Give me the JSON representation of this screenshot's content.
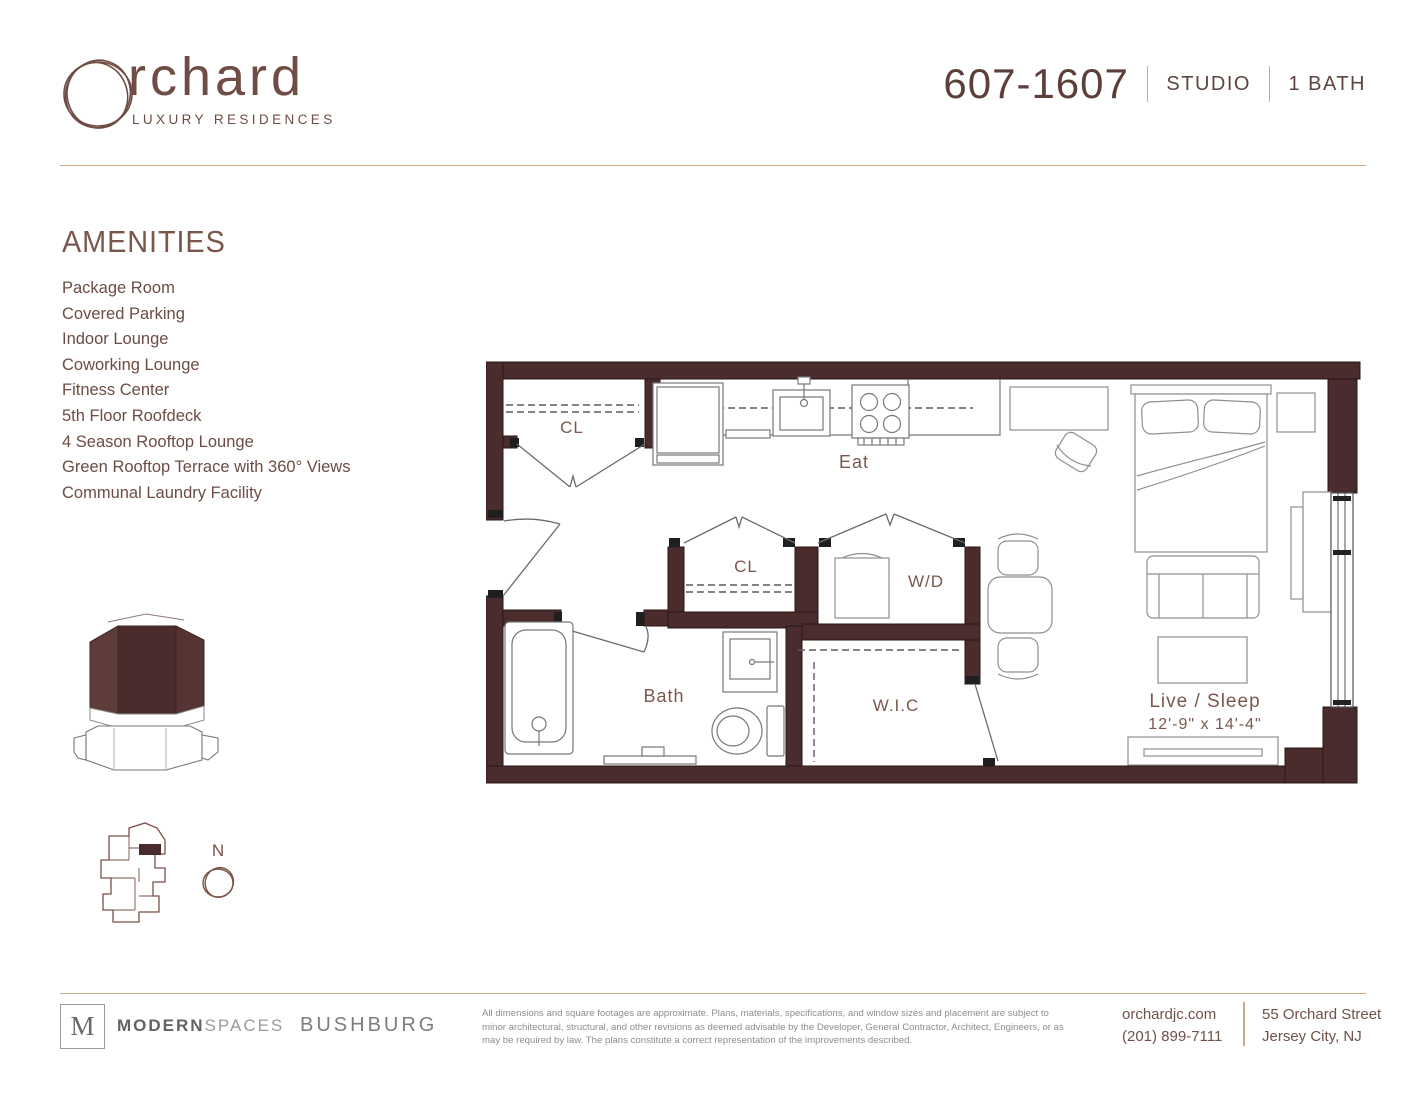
{
  "header": {
    "brand_text": "rchard",
    "brand_tagline": "LUXURY RESIDENCES",
    "unit_number": "607-1607",
    "unit_type": "STUDIO",
    "unit_bath": "1 BATH"
  },
  "amenities": {
    "heading": "AMENITIES",
    "items": [
      "Package Room",
      "Covered Parking",
      "Indoor Lounge",
      "Coworking Lounge",
      "Fitness Center",
      "5th Floor Roofdeck",
      "4 Season Rooftop Lounge",
      "Green Rooftop Terrace with 360° Views",
      "Communal Laundry Facility"
    ]
  },
  "floorplan": {
    "closet_top": "CL",
    "eat": "Eat",
    "closet_mid": "CL",
    "washer_dryer": "W/D",
    "bath": "Bath",
    "walk_in_closet": "W.I.C",
    "live_sleep": "Live / Sleep",
    "live_sleep_dims": "12'-9\" x 14'-4\"",
    "compass": "N"
  },
  "footer": {
    "broker_logo_letter": "M",
    "broker_name_bold": "MODERN",
    "broker_name_light": "SPACES",
    "developer": "BUSHBURG",
    "disclaimer": "All dimensions and square footages are approximate. Plans, materials, specifications, and window sizes and placement are subject to minor architectural, structural, and other revisions as deemed advisable by the Developer, General Contractor, Architect, Engineers, or as may be required by law. The plans constitute a correct representation of the improvements described.",
    "website": "orchardjc.com",
    "phone": "(201) 899-7111",
    "address_line1": "55 Orchard Street",
    "address_line2": "Jersey City, NJ"
  },
  "colors": {
    "wall": "#4b2c2c",
    "brand": "#6f4c44",
    "accent_line": "#cfa984",
    "label_text": "#7a584e",
    "footer_gray": "#8d8d8d"
  }
}
